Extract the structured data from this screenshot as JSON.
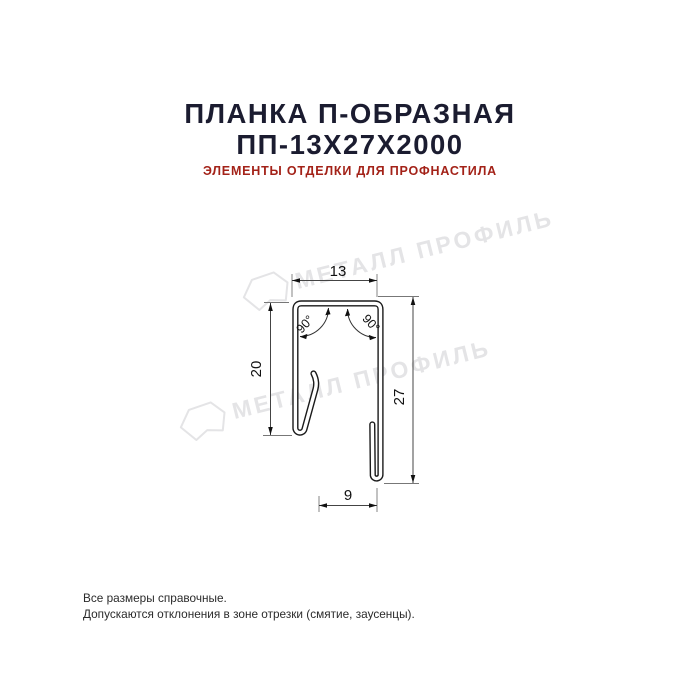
{
  "page": {
    "title_line1": "ПЛАНКА П-ОБРАЗНАЯ",
    "title_line2": "ПП-13Х27Х2000",
    "subtitle": "ЭЛЕМЕНТЫ ОТДЕЛКИ ДЛЯ ПРОФНАСТИЛА"
  },
  "colors": {
    "title": "#1b1c30",
    "subtitle_red": "#a32218",
    "drawing_line": "#1a1a1a",
    "watermark_gray": "#e4e4e6",
    "background": "#ffffff"
  },
  "drawing": {
    "type": "technical-cross-section",
    "product": "U-shaped strip profile",
    "dimensions": {
      "top_width": "13",
      "left_height": "20",
      "right_height": "27",
      "bottom_opening": "9",
      "angle_left": "90°",
      "angle_right": "90°"
    },
    "watermark_text": "МЕТАЛЛ ПРОФИЛЬ"
  },
  "footer": {
    "line1": "Все размеры справочные.",
    "line2": "Допускаются отклонения в зоне отрезки (смятие, заусенцы)."
  }
}
